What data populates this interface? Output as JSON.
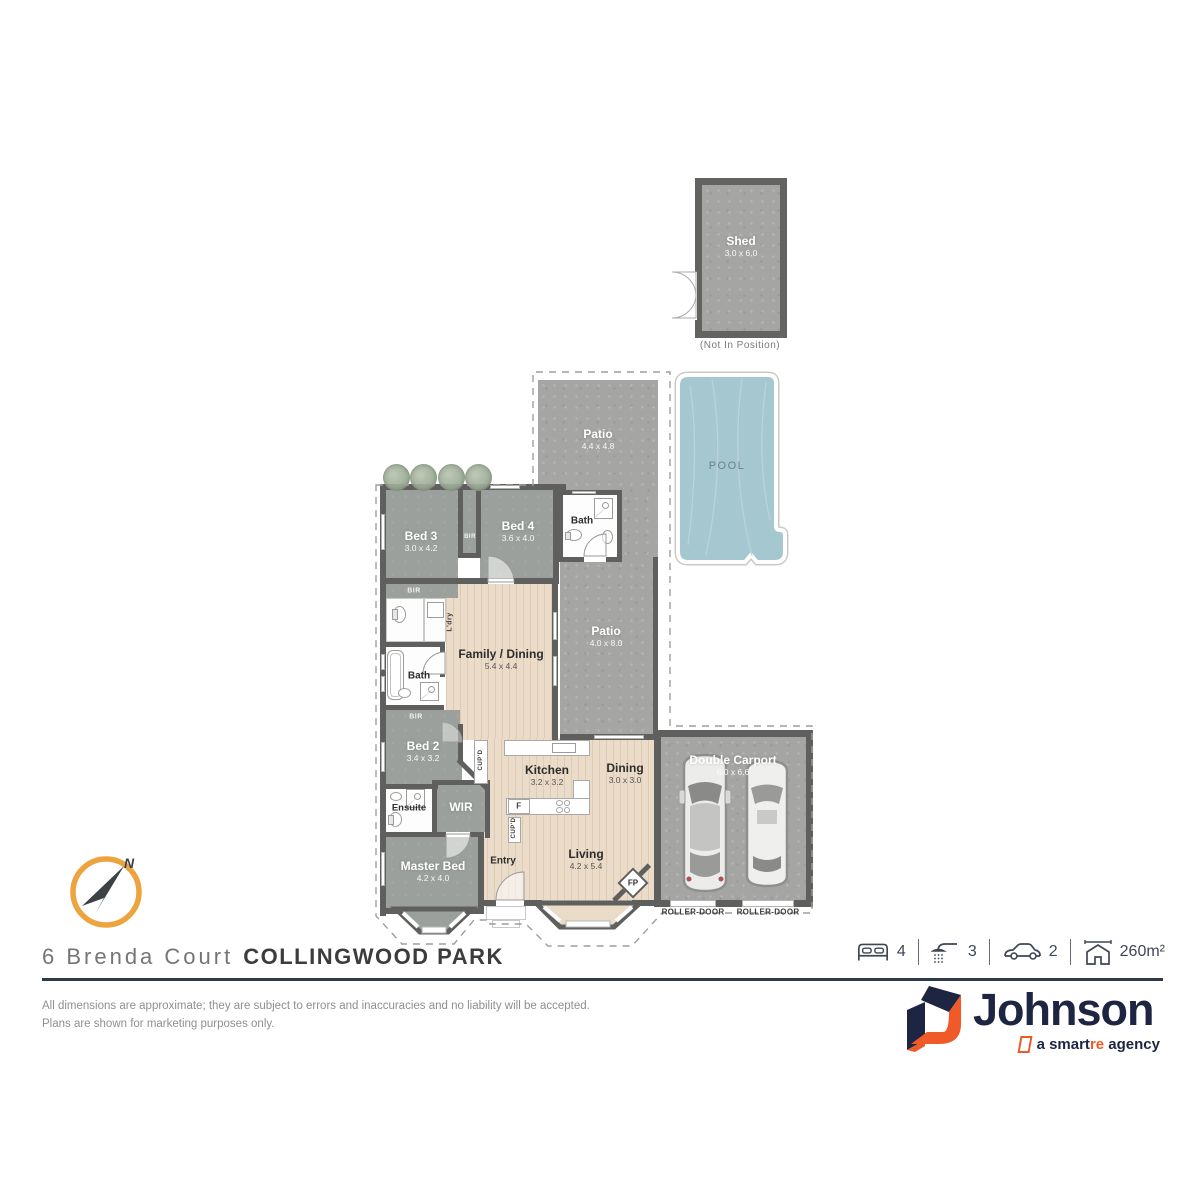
{
  "meta": {
    "address": "6 Brenda Court",
    "suburb": "COLLINGWOOD PARK"
  },
  "rooms": {
    "shed": {
      "label": "Shed",
      "dim": "3.0 x 6.0"
    },
    "patio_top": {
      "label": "Patio",
      "dim": "4.4 x 4.8"
    },
    "patio_right": {
      "label": "Patio",
      "dim": "4.0 x 8.0"
    },
    "bed3": {
      "label": "Bed 3",
      "dim": "3.0 x 4.2"
    },
    "bed4": {
      "label": "Bed 4",
      "dim": "3.6 x 4.0"
    },
    "bath_pool": {
      "label": "Bath"
    },
    "bath_mid": {
      "label": "Bath"
    },
    "bed2": {
      "label": "Bed 2",
      "dim": "3.4 x 3.2"
    },
    "family": {
      "label": "Family / Dining",
      "dim": "5.4 x 4.4"
    },
    "kitchen": {
      "label": "Kitchen",
      "dim": "3.2 x 3.2"
    },
    "dining": {
      "label": "Dining",
      "dim": "3.0 x 3.0"
    },
    "living": {
      "label": "Living",
      "dim": "4.2 x 5.4"
    },
    "entry": {
      "label": "Entry"
    },
    "ensuite": {
      "label": "Ensuite"
    },
    "wir": {
      "label": "WIR"
    },
    "master": {
      "label": "Master Bed",
      "dim": "4.2 x 4.0"
    },
    "carport": {
      "label": "Double Carport",
      "dim": "6.0 x 6.6"
    }
  },
  "labels": {
    "pool": "POOL",
    "not_in_position": "(Not In Position)",
    "bir": "BIR",
    "ldry": "L'dry",
    "cupd": "CUP'D",
    "fridge": "F",
    "fp": "FP",
    "roller_door": "ROLLER-DOOR",
    "north": "N"
  },
  "stats": {
    "beds": "4",
    "baths": "3",
    "cars": "2",
    "area": "260m²"
  },
  "disclaimer": {
    "line1": "All dimensions are approximate; they are subject to errors and inaccuracies and no liability will be accepted.",
    "line2": "Plans are shown for marketing purposes only."
  },
  "brand": {
    "name": "Johnson",
    "tagline_pre": "a smart",
    "tagline_accent": "re",
    "tagline_post": " agency"
  },
  "colors": {
    "wall": "#5f5f5d",
    "concrete": "#a5a5a3",
    "room_gray": "#9ba09c",
    "timber": "#ebdcc9",
    "pool_water": "#a5c8d0",
    "accent_orange": "#f05a28",
    "brand_navy": "#1d2542",
    "compass_ring": "#eea43e",
    "underline": "#2c3a49"
  }
}
